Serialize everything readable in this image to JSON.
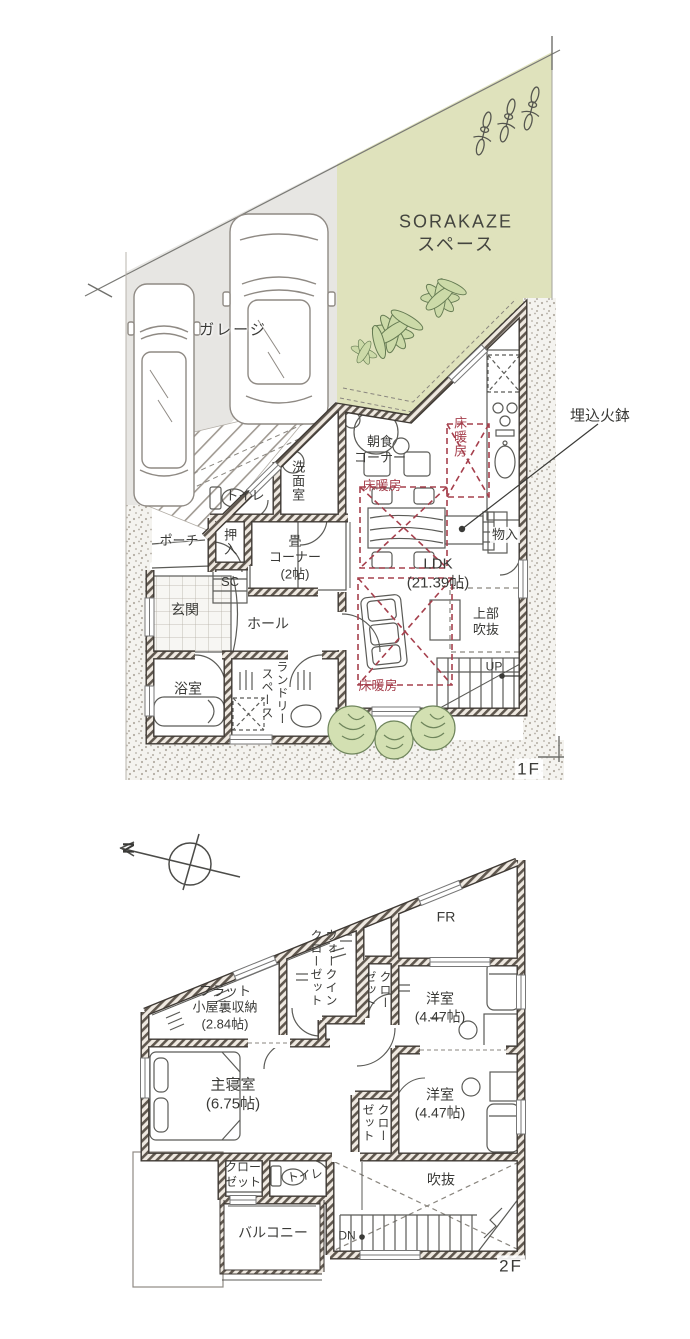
{
  "colors": {
    "sorakaze_zone_green": "#dfe2bc",
    "garage_zone_gray": "#e7e6e3",
    "floor_heating_red": "#a6404d",
    "wall_hatch": "#60584f",
    "plant_green": "#ccdaa8"
  },
  "floor1": {
    "floor_label": "1F",
    "site": {
      "garage_label": "ガレージ",
      "sorakaze_label": "SORAKAZE\nスペース"
    },
    "annotations": {
      "hibachi": "埋込火鉢"
    },
    "rooms": {
      "breakfast": "朝食\nコーナー",
      "floor_heating_kitchen": "床暖房",
      "floor_heating_dining": "床暖房",
      "floor_heating_living": "床暖房",
      "pantry": "物入",
      "toilet": "トイレ",
      "washroom": "洗面室",
      "oshiire": "押入",
      "porch": "ポーチ",
      "tatami_corner": "畳\nコーナー\n(2帖)",
      "shoe_closet": "SC",
      "entrance": "玄関",
      "hall": "ホール",
      "bathroom": "浴室",
      "laundry": "ランドリー\nスペース",
      "ldk": "LDK\n(21.39帖)",
      "upper_void": "上部\n吹抜",
      "up": "UP"
    }
  },
  "floor2": {
    "floor_label": "2F",
    "compass_north": "N",
    "rooms": {
      "attic_storage": "フラット\n小屋裏収納\n(2.84帖)",
      "walk_in_closet": "ウォークイン\nクローゼット",
      "closet_north": "クロー\nゼット",
      "free_room": "FR",
      "bedroom_east": "洋室\n(4.47帖)",
      "bedroom_south": "洋室\n(4.47帖)",
      "master_bedroom": "主寝室\n(6.75帖)",
      "master_closet": "クロー\nゼット",
      "toilet": "トイレ",
      "closet_hall": "クロー\nゼット",
      "balcony": "バルコニー",
      "void": "吹抜",
      "dn": "DN"
    }
  }
}
